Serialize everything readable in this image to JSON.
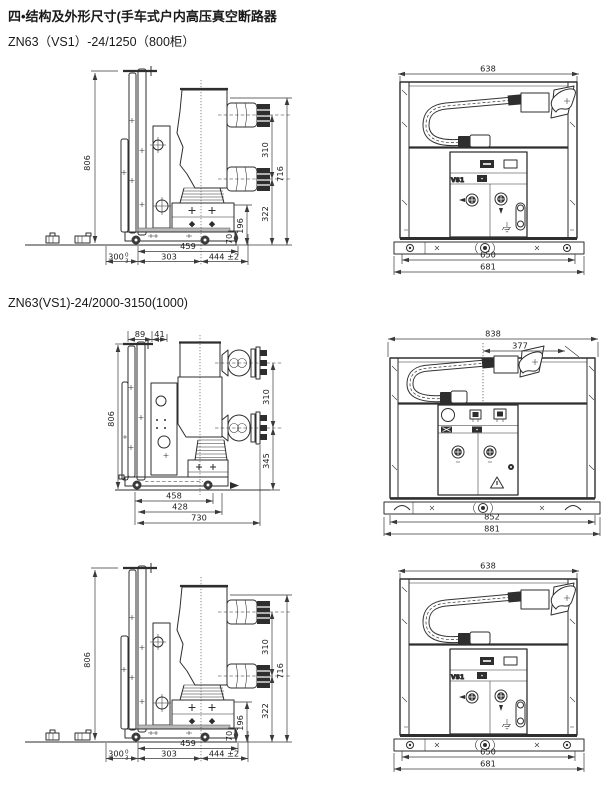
{
  "page": {
    "title": "四•结构及外形尺寸(手车式户内高压真空断路器",
    "subtitle_1": "ZN63（VS1）-24/1250（800柜）",
    "subtitle_2": "ZN63(VS1)-24/2000-3150(1000)"
  },
  "colors": {
    "line": "#2e2e2e",
    "paper": "#ffffff"
  },
  "drawings": {
    "side_800": {
      "height": "806",
      "arm_pitch": "310",
      "total_height": "716",
      "lower_height": "322",
      "box_height": "196",
      "base_height": "70",
      "depth_1": "459",
      "tol_dim": "300",
      "tol_upper": "0",
      "tol_lower": "3",
      "depth_2": "303",
      "depth_3": "444 ±2"
    },
    "front_800": {
      "width_top": "638",
      "width_inner": "650",
      "width_outer": "681",
      "panel_label": "VS1"
    },
    "side_1000": {
      "top_dim_1": "89",
      "top_dim_2": "41",
      "height": "806",
      "arm_pitch": "310",
      "lower_height": "345",
      "depth_1": "458",
      "depth_2": "428",
      "depth_3": "730"
    },
    "front_1000": {
      "width_top": "838",
      "width_inner_top": "377",
      "width_inner": "852",
      "width_outer": "881"
    }
  }
}
